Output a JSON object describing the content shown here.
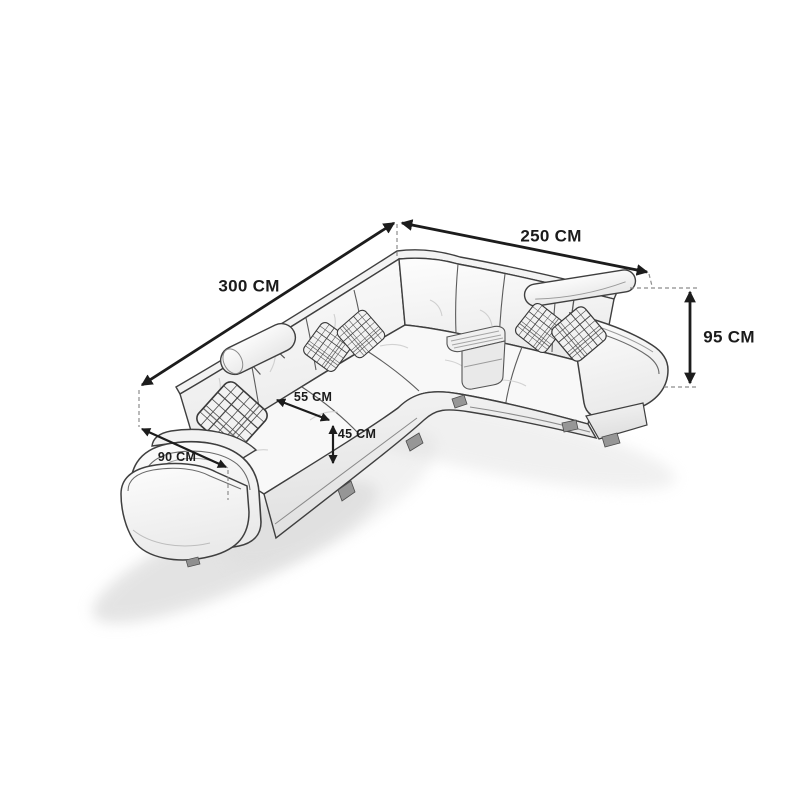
{
  "page": {
    "background_color": "#ffffff",
    "width_px": 800,
    "height_px": 800
  },
  "diagram": {
    "subject": "corner-sofa-dimension-line-drawing",
    "units": "CM",
    "annotation_color": "#1b1b1b",
    "dash_color": "#8c8c8c",
    "sketch_outline_color": "#3f3f3f",
    "dimensions": {
      "right_side_length": {
        "label": "250 CM",
        "value": 250
      },
      "left_side_length": {
        "label": "300 CM",
        "value": 300
      },
      "back_height": {
        "label": "95 CM",
        "value": 95
      },
      "seat_depth": {
        "label": "55 CM",
        "value": 55
      },
      "seat_height": {
        "label": "45 CM",
        "value": 45
      },
      "armrest_width": {
        "label": "90 CM",
        "value": 90
      }
    }
  }
}
